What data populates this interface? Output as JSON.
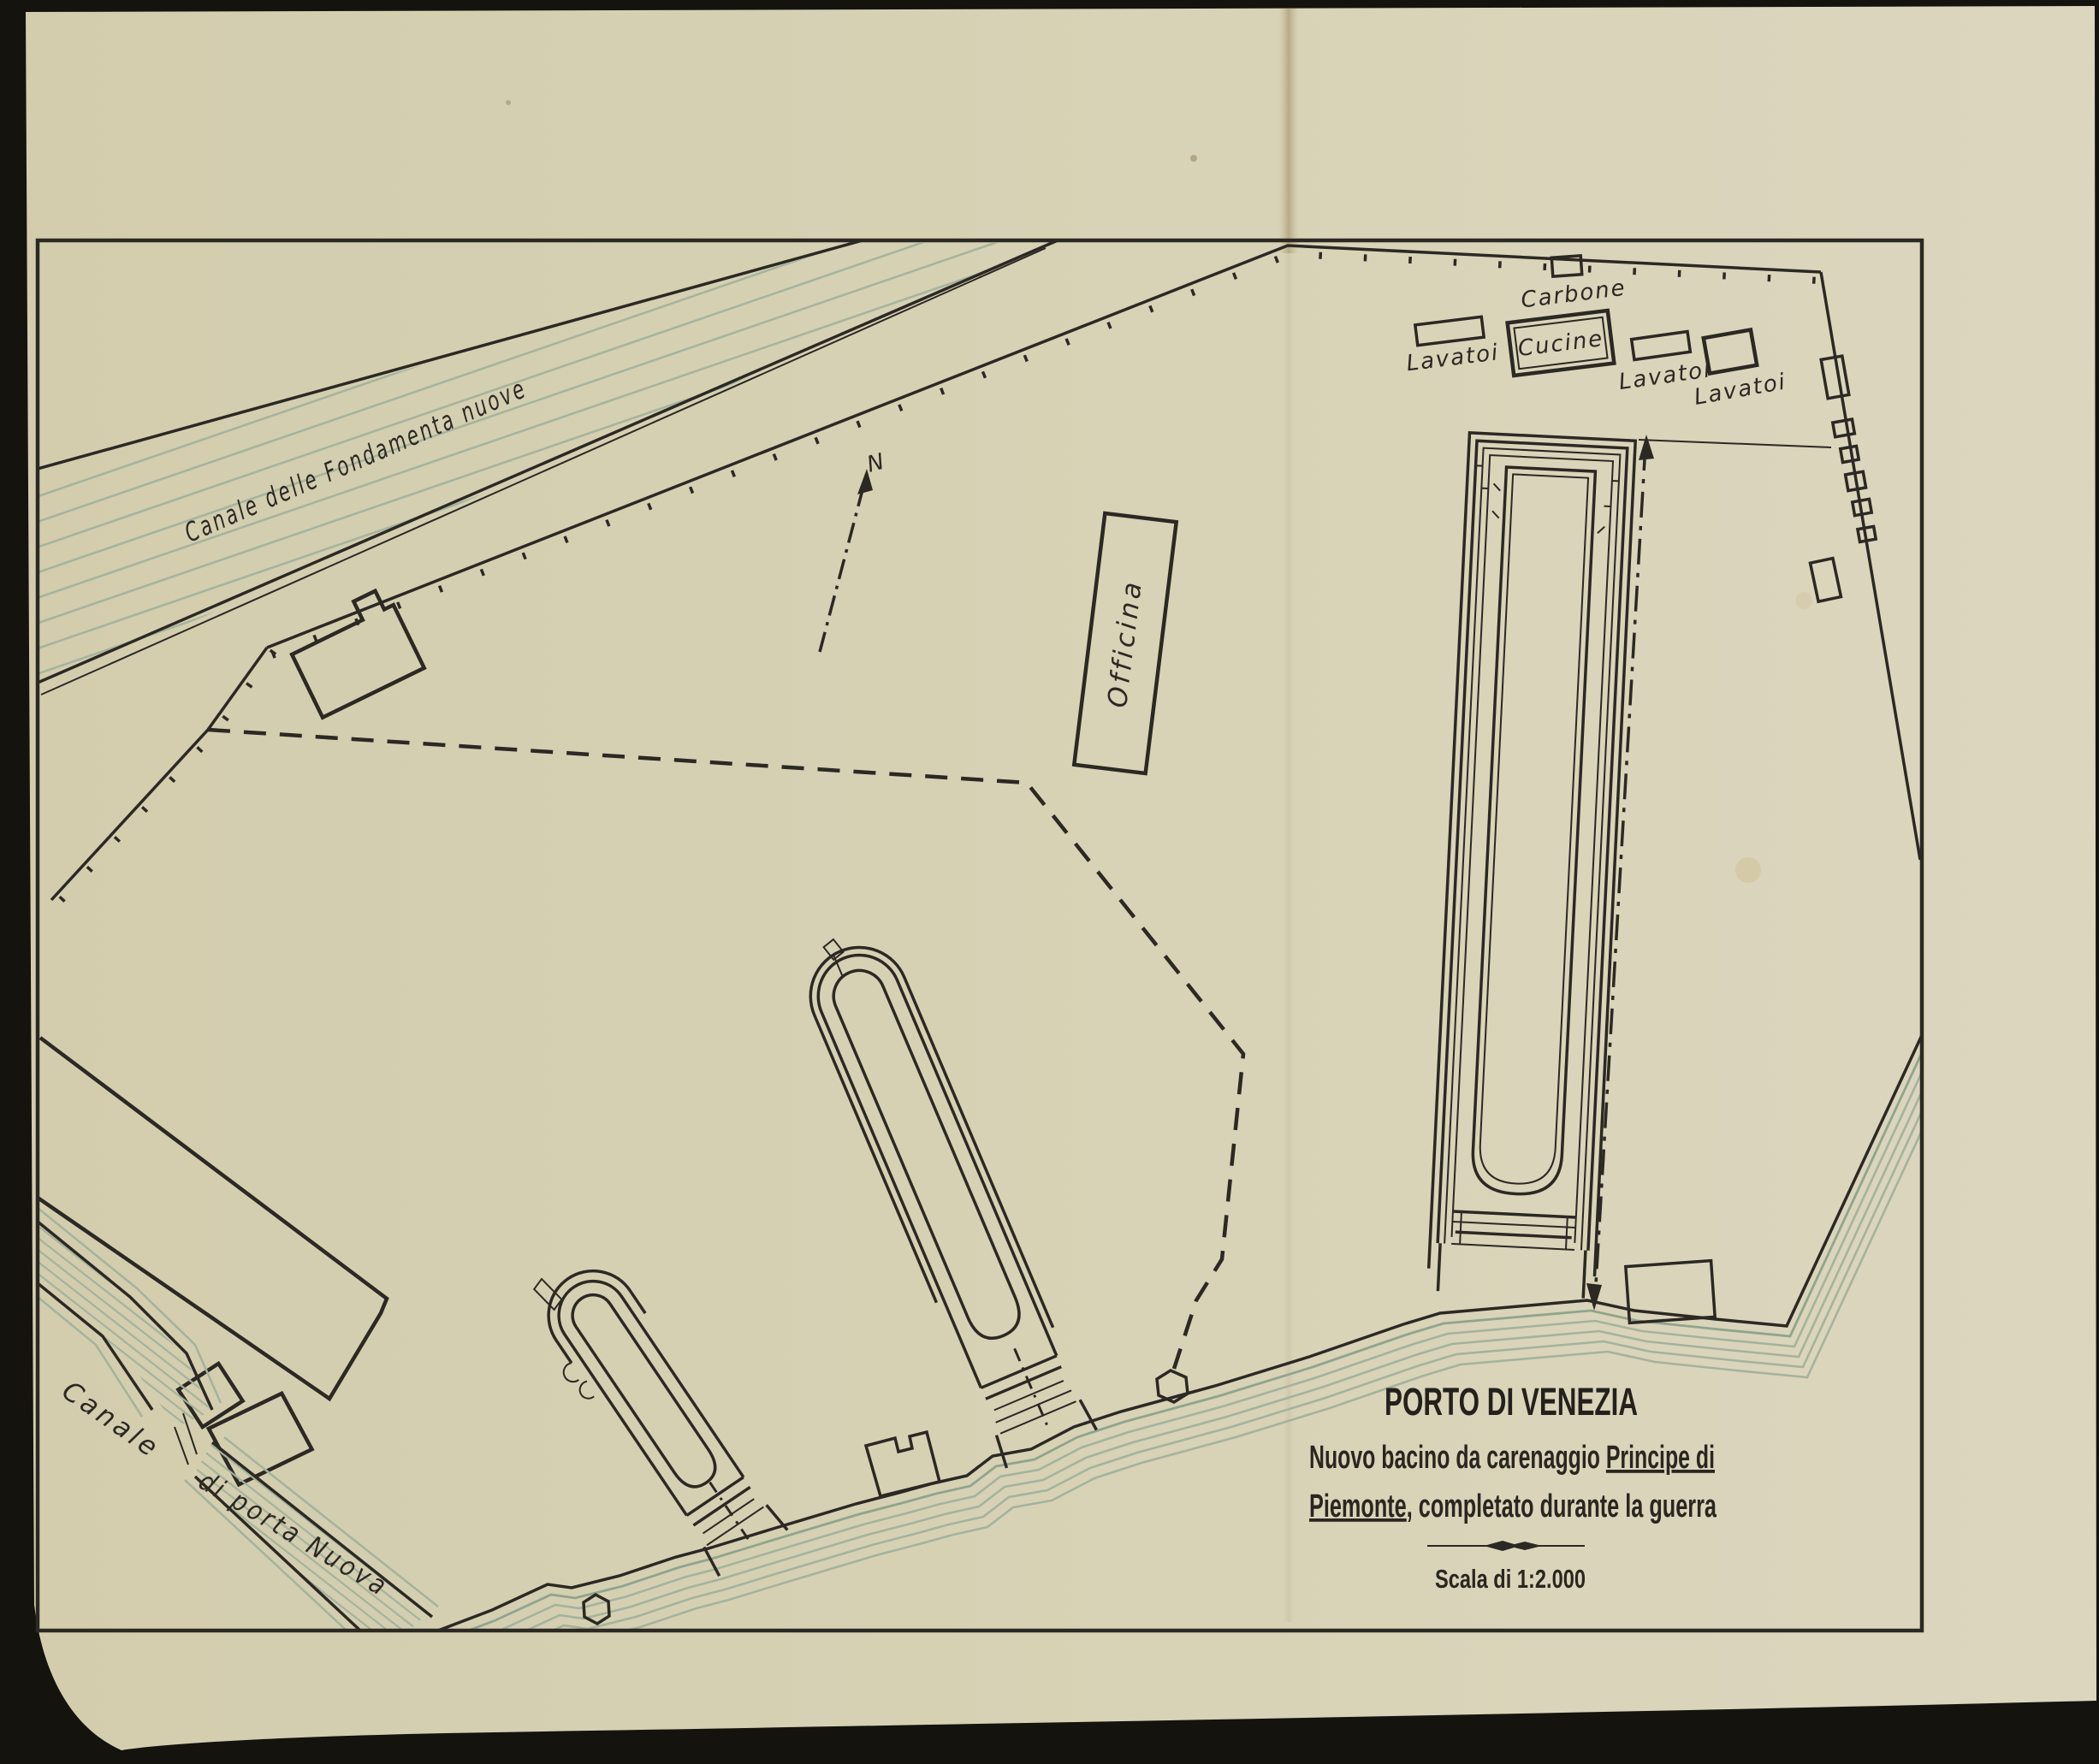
{
  "page": {
    "kind": "scanned map plate",
    "colors": {
      "paper": "#d8d2b6",
      "ink": "#2c2823",
      "contour_green": "#a4b39c",
      "page_edge_dark": "#14130e"
    }
  },
  "title_block": {
    "title": "PORTO DI VENEZIA",
    "subtitle_1_plain": "Nuovo bacino da carenaggio ",
    "subtitle_1_underlined": "Principe di",
    "subtitle_2_underlined": "Piemonte",
    "subtitle_2_plain": ", completato durante la guerra",
    "scale_label": "Scala di 1:2.000"
  },
  "map_labels": {
    "canal_north": "Canale delle Fondamenta nuove",
    "canal_west_line1": "Canale",
    "canal_west_line2": "di porta Nuova",
    "coal": "Carbone",
    "kitchens": "Cucine",
    "washhouse_1": "Lavatoi",
    "washhouse_2": "Lavatoi",
    "washhouse_3": "Lavatoi",
    "workshop": "Officina",
    "north_letter": "N"
  }
}
